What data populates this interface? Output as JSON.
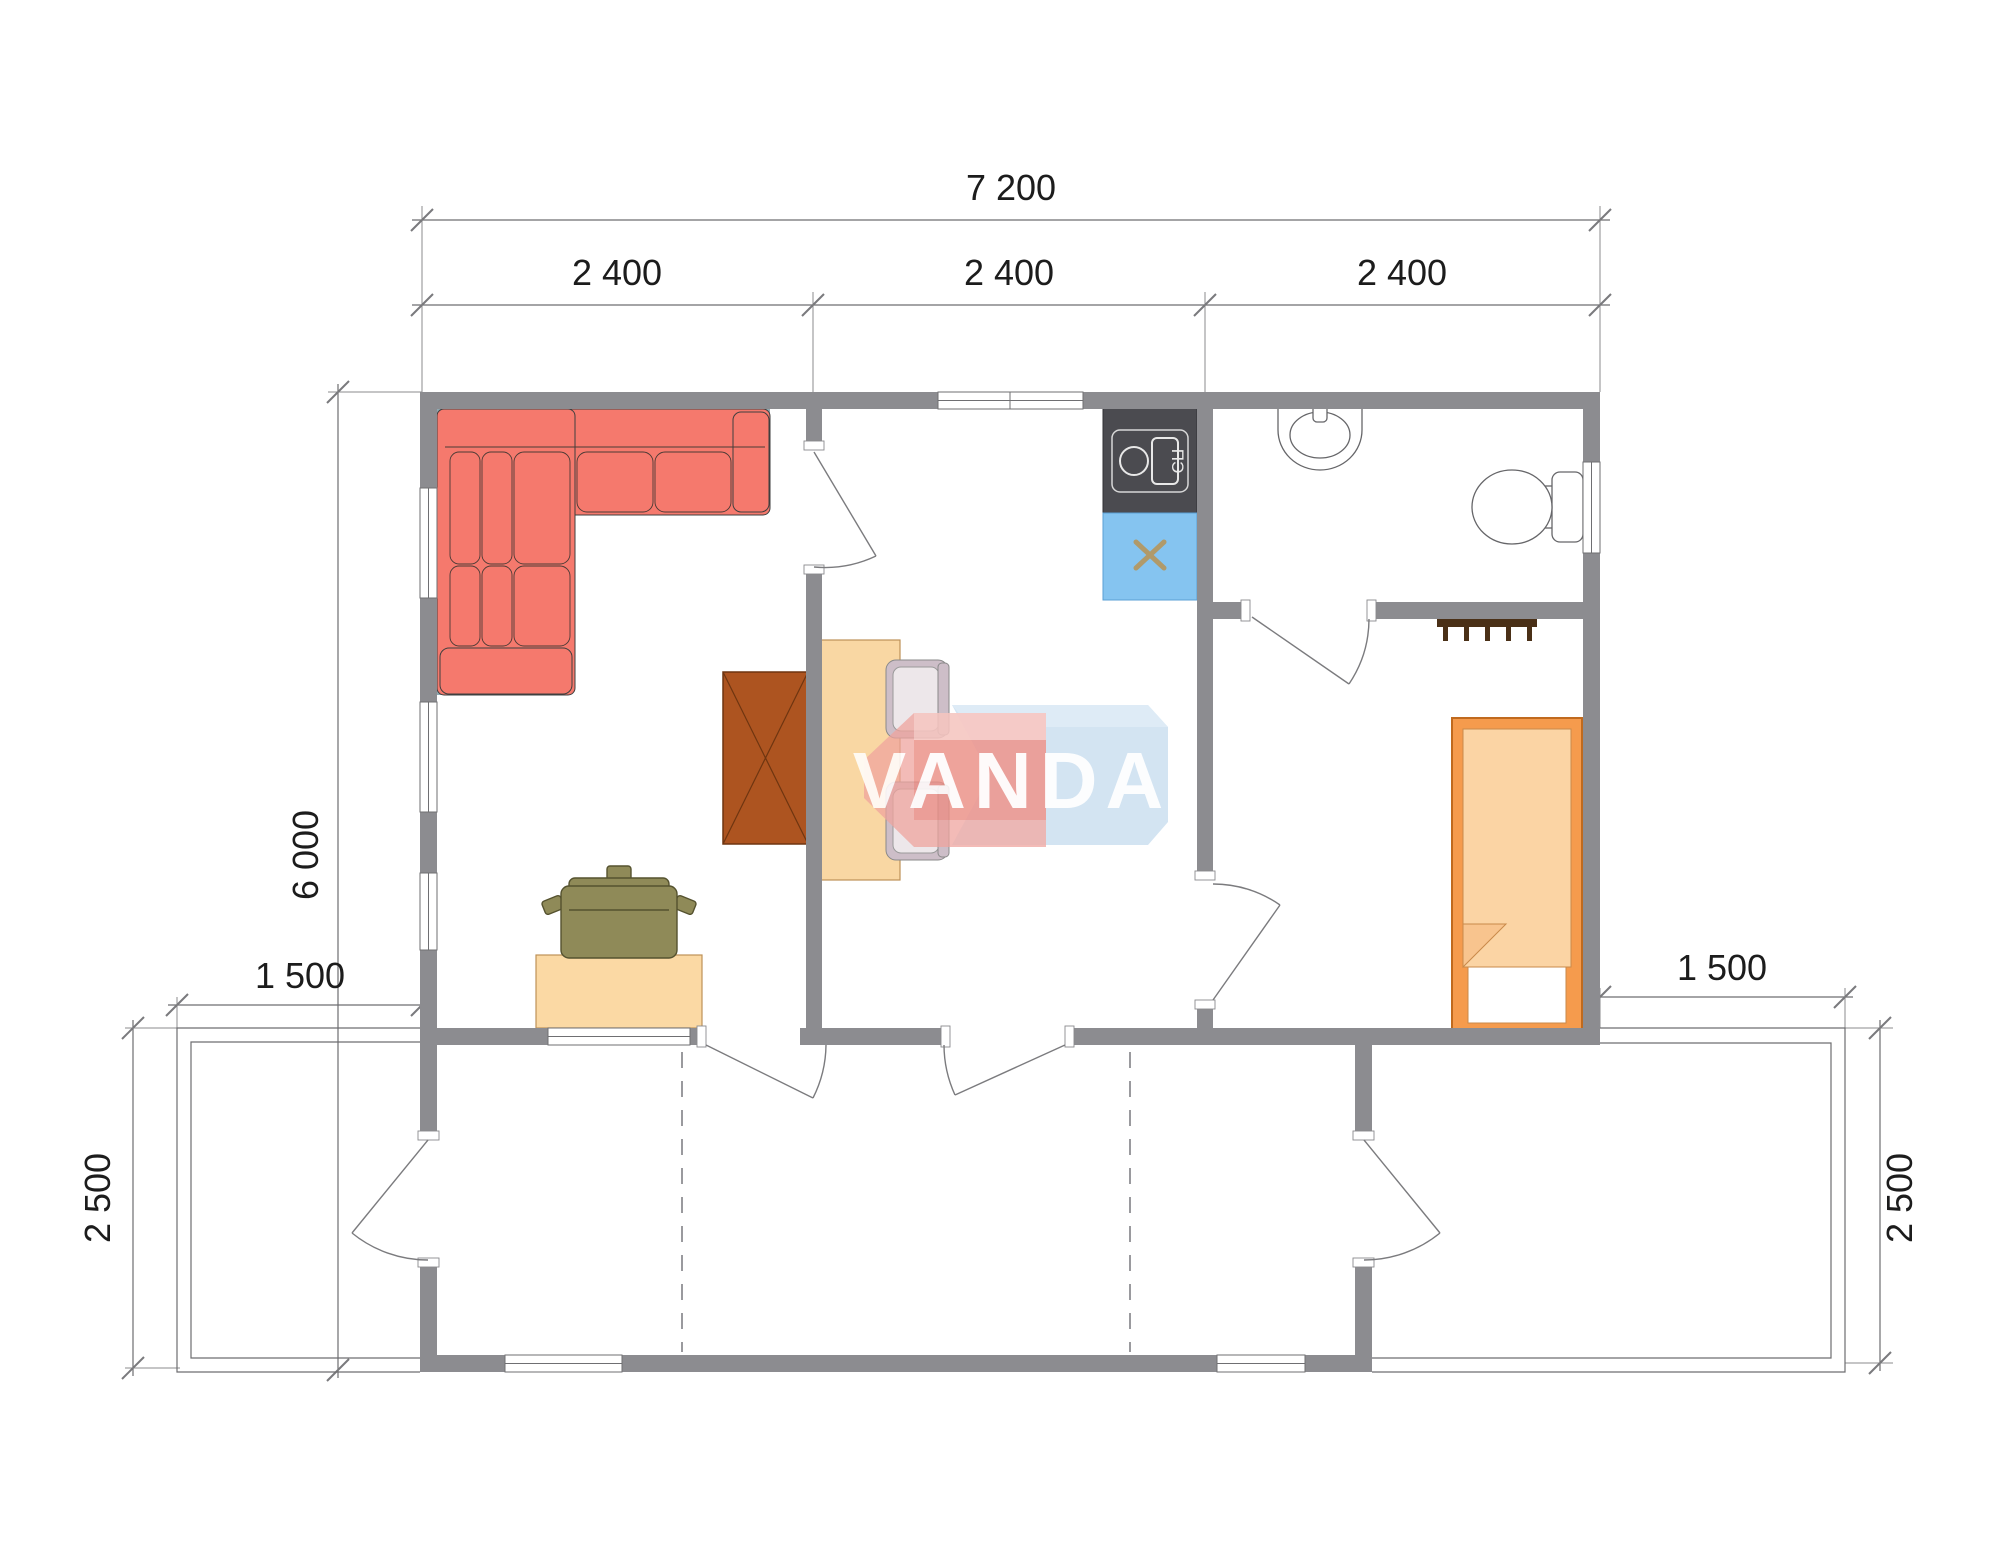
{
  "meta": {
    "type": "architectural-floor-plan"
  },
  "watermark": {
    "text": "VANDA",
    "red": "#EFA49D",
    "blue": "#C6DCEE"
  },
  "dimensions": {
    "top_total": "7 200",
    "top_modules": [
      "2 400",
      "2 400",
      "2 400"
    ],
    "left_height": "6 000",
    "left_terrace_width": "1 500",
    "left_terrace_depth": "2 500",
    "right_terrace_width": "1 500",
    "right_terrace_depth": "2 500"
  },
  "labels": {
    "stove": "ПЭ"
  },
  "objects": [
    "corner-sofa",
    "wardrobe",
    "dining-table",
    "dining-chair",
    "dining-chair",
    "desk",
    "office-chair",
    "kitchen-counter-stove",
    "kitchen-sink-cabinet",
    "washbasin",
    "toilet",
    "coat-hooks",
    "bed",
    "terrace-left-deck",
    "terrace-right-deck",
    "veranda"
  ],
  "colors": {
    "wall": "#8C8C90",
    "sofa": "#F5796D",
    "wardrobe": "#AD5420",
    "table": "#F9D7A3",
    "desk": "#FBD9A4",
    "office_chair": "#8F8A58",
    "dining_chair": "#CDBEC8",
    "counter_dark": "#4B4B50",
    "sink_blue": "#85C4F0",
    "bed_frame": "#F59B4D",
    "bed_blanket": "#FBD4A4",
    "dim_text": "#1c1c1c"
  }
}
